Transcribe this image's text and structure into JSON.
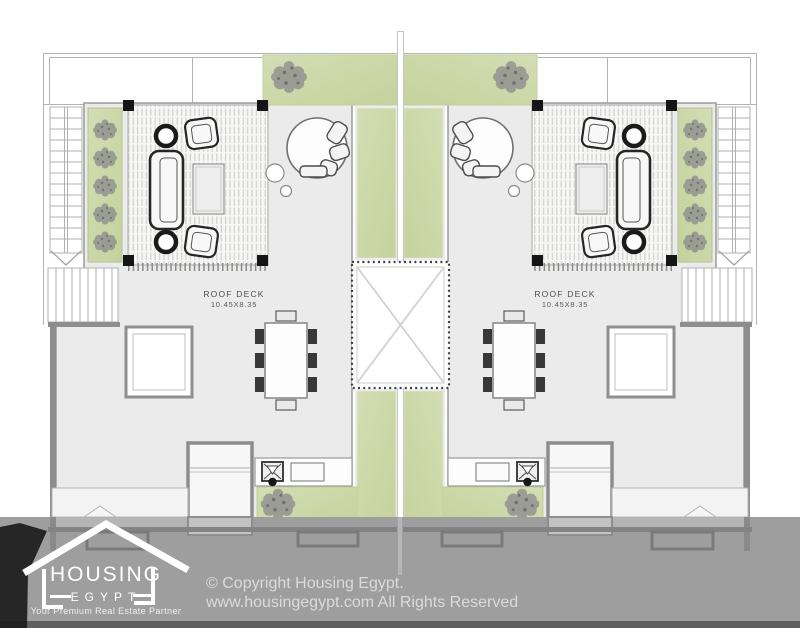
{
  "plan": {
    "units": [
      {
        "label": "ROOF DECK",
        "dimensions": "10.45X8.35"
      },
      {
        "label": "ROOF DECK",
        "dimensions": "10.45X8.35"
      }
    ]
  },
  "watermark": {
    "logo": {
      "name": "HOUSING",
      "sub": "EGYPT",
      "tagline": "Your Premium Real Estate Partner"
    },
    "copyright_line1": "© Copyright Housing Egypt.",
    "copyright_line2": "www.housingegypt.com All Rights Reserved"
  },
  "colors": {
    "landscape_green": "#cbd7a4",
    "overlay_gray": "#9e9e9e",
    "deck_gray": "#ebebec",
    "wall_gray": "#8d8d8d",
    "column_black": "#151515",
    "logo_white": "#ffffff"
  }
}
